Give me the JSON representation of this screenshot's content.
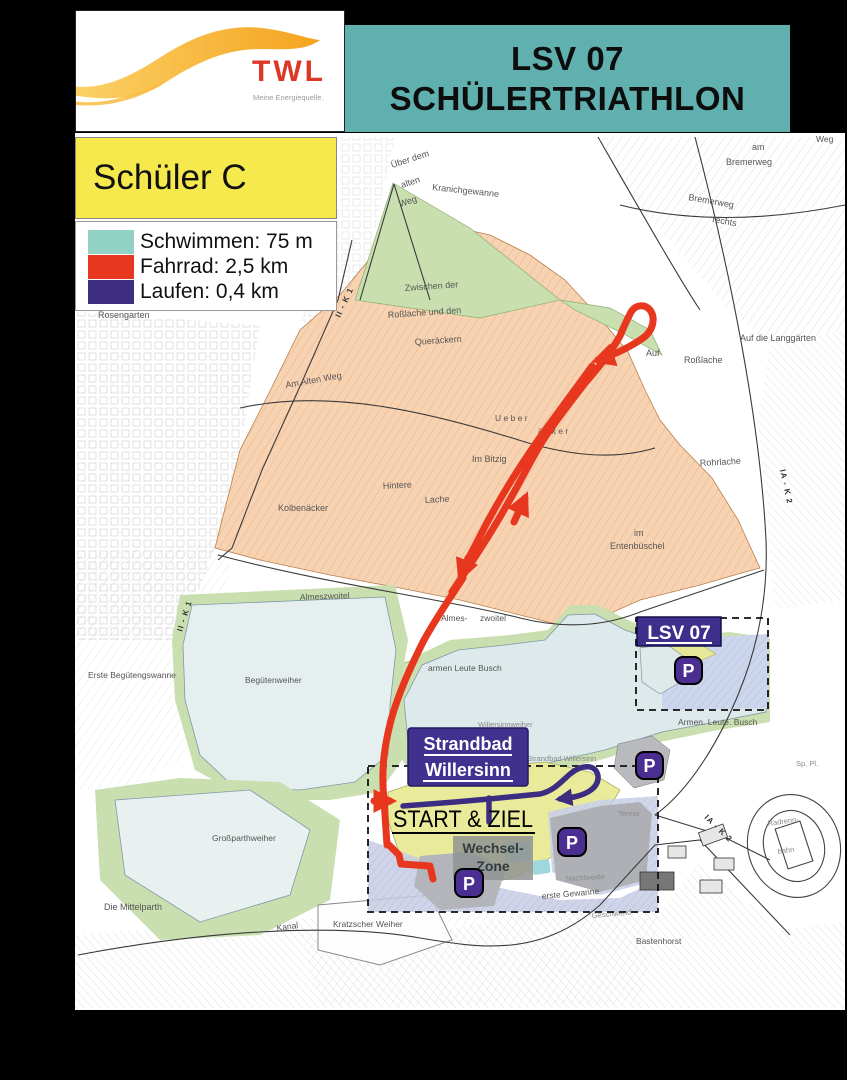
{
  "header": {
    "logo": {
      "brand": "TWL",
      "tagline": "Meine Energiequelle."
    },
    "banner": {
      "line1": "LSV 07",
      "line2": "SCHÜLERTRIATHLON",
      "bg_color": "#5fb0ae"
    }
  },
  "legend": {
    "category": "Schüler C",
    "category_bg": "#f6e94d",
    "items": [
      {
        "sport": "Schwimmen",
        "label": "Schwimmen: 75 m",
        "color": "#92d2c4"
      },
      {
        "sport": "Fahrrad",
        "label": "Fahrrad: 2,5 km",
        "color": "#e8371f"
      },
      {
        "sport": "Laufen",
        "label": "Laufen: 0,4 km",
        "color": "#3d2d80"
      }
    ]
  },
  "map": {
    "overlays": {
      "lsv07": "LSV 07",
      "strandbad_line1": "Strandbad",
      "strandbad_line2": "Willersinn",
      "start_ziel": "START & ZIEL",
      "wechsel_line1": "Wechsel-",
      "wechsel_line2": "Zone",
      "parking": "P"
    },
    "route_colors": {
      "bike": "#e8371f",
      "run": "#3d2d80",
      "swim": "#92d2c4"
    },
    "labels": {
      "ueber_dem": "Über dem",
      "alten": "alten",
      "weg_nw": "Weg",
      "kranichgewanne": "Kranichgewanne",
      "bremerweg_r": "Bremerweg",
      "rechts": "rechts",
      "am_ne": "am",
      "bremerweg_ne": "Bremerweg",
      "weg_ne": "Weg",
      "rosengarten": "Rosengarten",
      "zwischen_der": "Zwischen der",
      "rosslache_und_den": "Roßlache und den",
      "queraeckern": "Queräckern",
      "auf": "Auf",
      "rosslache": "Roßlache",
      "auf_die_langgaerten": "Auf die Langgärten",
      "am_alten_weg": "Am Alten Weg",
      "ueber_sp": "U e b e r",
      "aecker_sp": "ä c k e r",
      "im_bitzig": "Im Bitzig",
      "hintere": "Hintere",
      "lache": "Lache",
      "kolbenaecker": "Kolbenäcker",
      "im_e1": "im",
      "im_e2": "Entenbüschel",
      "rohrlache": "Rohrlache",
      "almeszwoitel": "Almeszwoitel",
      "almes2": "Almes-",
      "zwoitel2": "zwoitel",
      "erste_beguetengswanne": "Erste  Begütengswanne",
      "beguetenweiher": "Begütenweiher",
      "armen_leute_busch_w": "armen   Leute   Busch",
      "armen_leute_busch_e": "Armen. Leute. Busch",
      "willersinnweiher": "Willersinnweiher",
      "strandbad_willersinn_klein": "Strandbad Willersinn",
      "grossparthweiher": "Großparthweiher",
      "die_mittelparth": "Die Mittelparth",
      "kanal": "Kanal",
      "kratzscher_weiher": "Kratzscher   Weiher",
      "erste_gewanne": "erste  Gewanne",
      "nachtweide": "Nachtweide",
      "geschwend": "Geschwend",
      "bastenhorst": "Bastenhorst",
      "radrenn": "Radrenn-",
      "bahn": "bahn",
      "sp_pl": "Sp. Pl.",
      "ia_k2_a": "IA - K 2",
      "ia_k2_b": "IA - K 2",
      "ii_k1_a": "II - K 1",
      "ii_k1_b": "II - K 1",
      "tennis": "Tennis"
    }
  }
}
